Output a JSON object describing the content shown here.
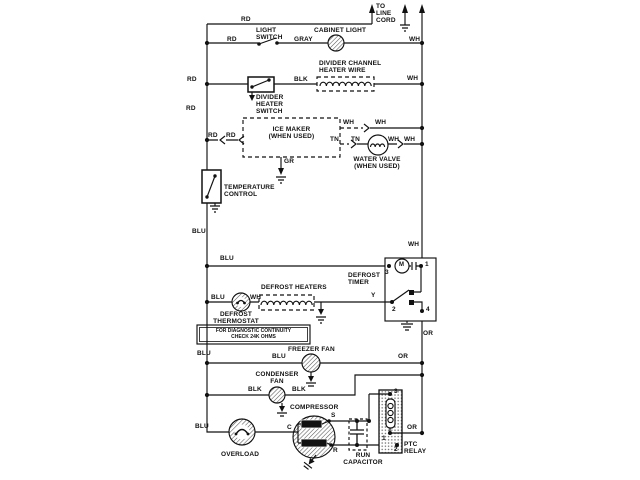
{
  "diagram": {
    "labels": {
      "to_line_cord": "TO\nLINE\nCORD",
      "light_switch": "LIGHT\nSWITCH",
      "cabinet_light": "CABINET LIGHT",
      "divider_channel_heater_wire": "DIVIDER CHANNEL\nHEATER WIRE",
      "divider_heater_switch": "DIVIDER\nHEATER\nSWITCH",
      "ice_maker": "ICE MAKER\n(WHEN USED)",
      "water_valve": "WATER VALVE\n(WHEN USED)",
      "temperature_control": "TEMPERATURE\nCONTROL",
      "defrost_timer": "DEFROST\nTIMER",
      "defrost_heaters": "DEFROST HEATERS",
      "defrost_thermostat": "DEFROST\nTHERMOSTAT",
      "diagnostic_note": "FOR DIAGNOSTIC CONTINUITY\nCHECK 24K OHMS",
      "freezer_fan": "FREEZER FAN",
      "condenser_fan": "CONDENSER\nFAN",
      "compressor": "COMPRESSOR",
      "overload": "OVERLOAD",
      "run_capacitor": "RUN\nCAPACITOR",
      "ptc_relay": "PTC\nRELAY"
    },
    "wire_labels": {
      "rd_top": "RD",
      "rd_light": "RD",
      "gray": "GRAY",
      "wh_light": "WH",
      "rd_divider": "RD",
      "blk_divider": "BLK",
      "wh_divider": "WH",
      "rd_bus": "RD",
      "rd_ice_1": "RD",
      "rd_ice_2": "RD",
      "wh_ice_1": "WH",
      "wh_ice_2": "WH",
      "tn_1": "TN",
      "tn_2": "TN",
      "wh_valve_1": "WH",
      "wh_valve_2": "WH",
      "gr_ice": "GR",
      "blu_bus_mid": "BLU",
      "blu_timer": "BLU",
      "wh_timer": "WH",
      "y_timer": "Y",
      "or_timer": "OR",
      "blu_thermostat": "BLU",
      "wh_thermostat": "WH",
      "blu_bus_low": "BLU",
      "blu_freezer": "BLU",
      "or_freezer": "OR",
      "blk_cond_1": "BLK",
      "blk_cond_2": "BLK",
      "blu_bottom": "BLU",
      "or_ptc": "OR"
    },
    "terminals": {
      "timer_motor": "M",
      "timer_1": "1",
      "timer_2": "2",
      "timer_3": "3",
      "timer_4": "4",
      "comp_c": "C",
      "comp_s": "S",
      "comp_r": "R",
      "ptc_1": "1",
      "ptc_2": "2",
      "ptc_3": "3"
    },
    "colors": {
      "ink": "#111111",
      "background": "#ffffff"
    }
  }
}
